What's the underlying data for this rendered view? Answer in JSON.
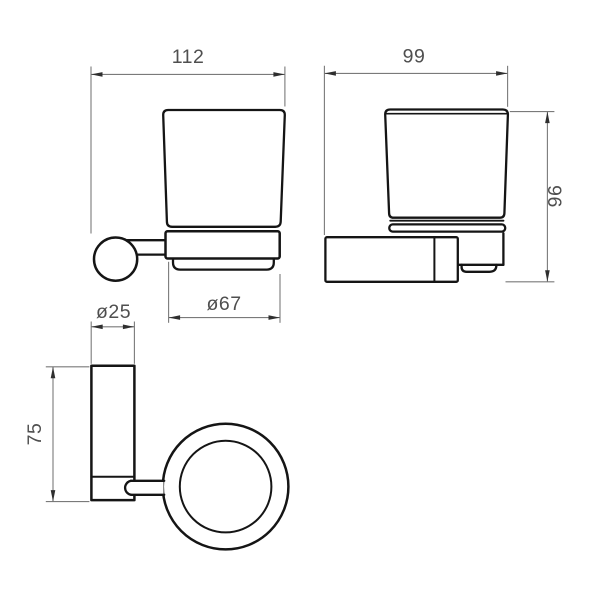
{
  "drawing": {
    "dimensions": {
      "front_width": "112",
      "side_depth": "99",
      "side_height": "96",
      "glass_diameter": "ø67",
      "post_diameter": "ø25",
      "post_height": "75"
    },
    "colors": {
      "line_color": "#151515",
      "dimension_color": "#7a7a7a",
      "dimension_text_color": "#4f4f4f",
      "background_color": "#ffffff"
    }
  }
}
